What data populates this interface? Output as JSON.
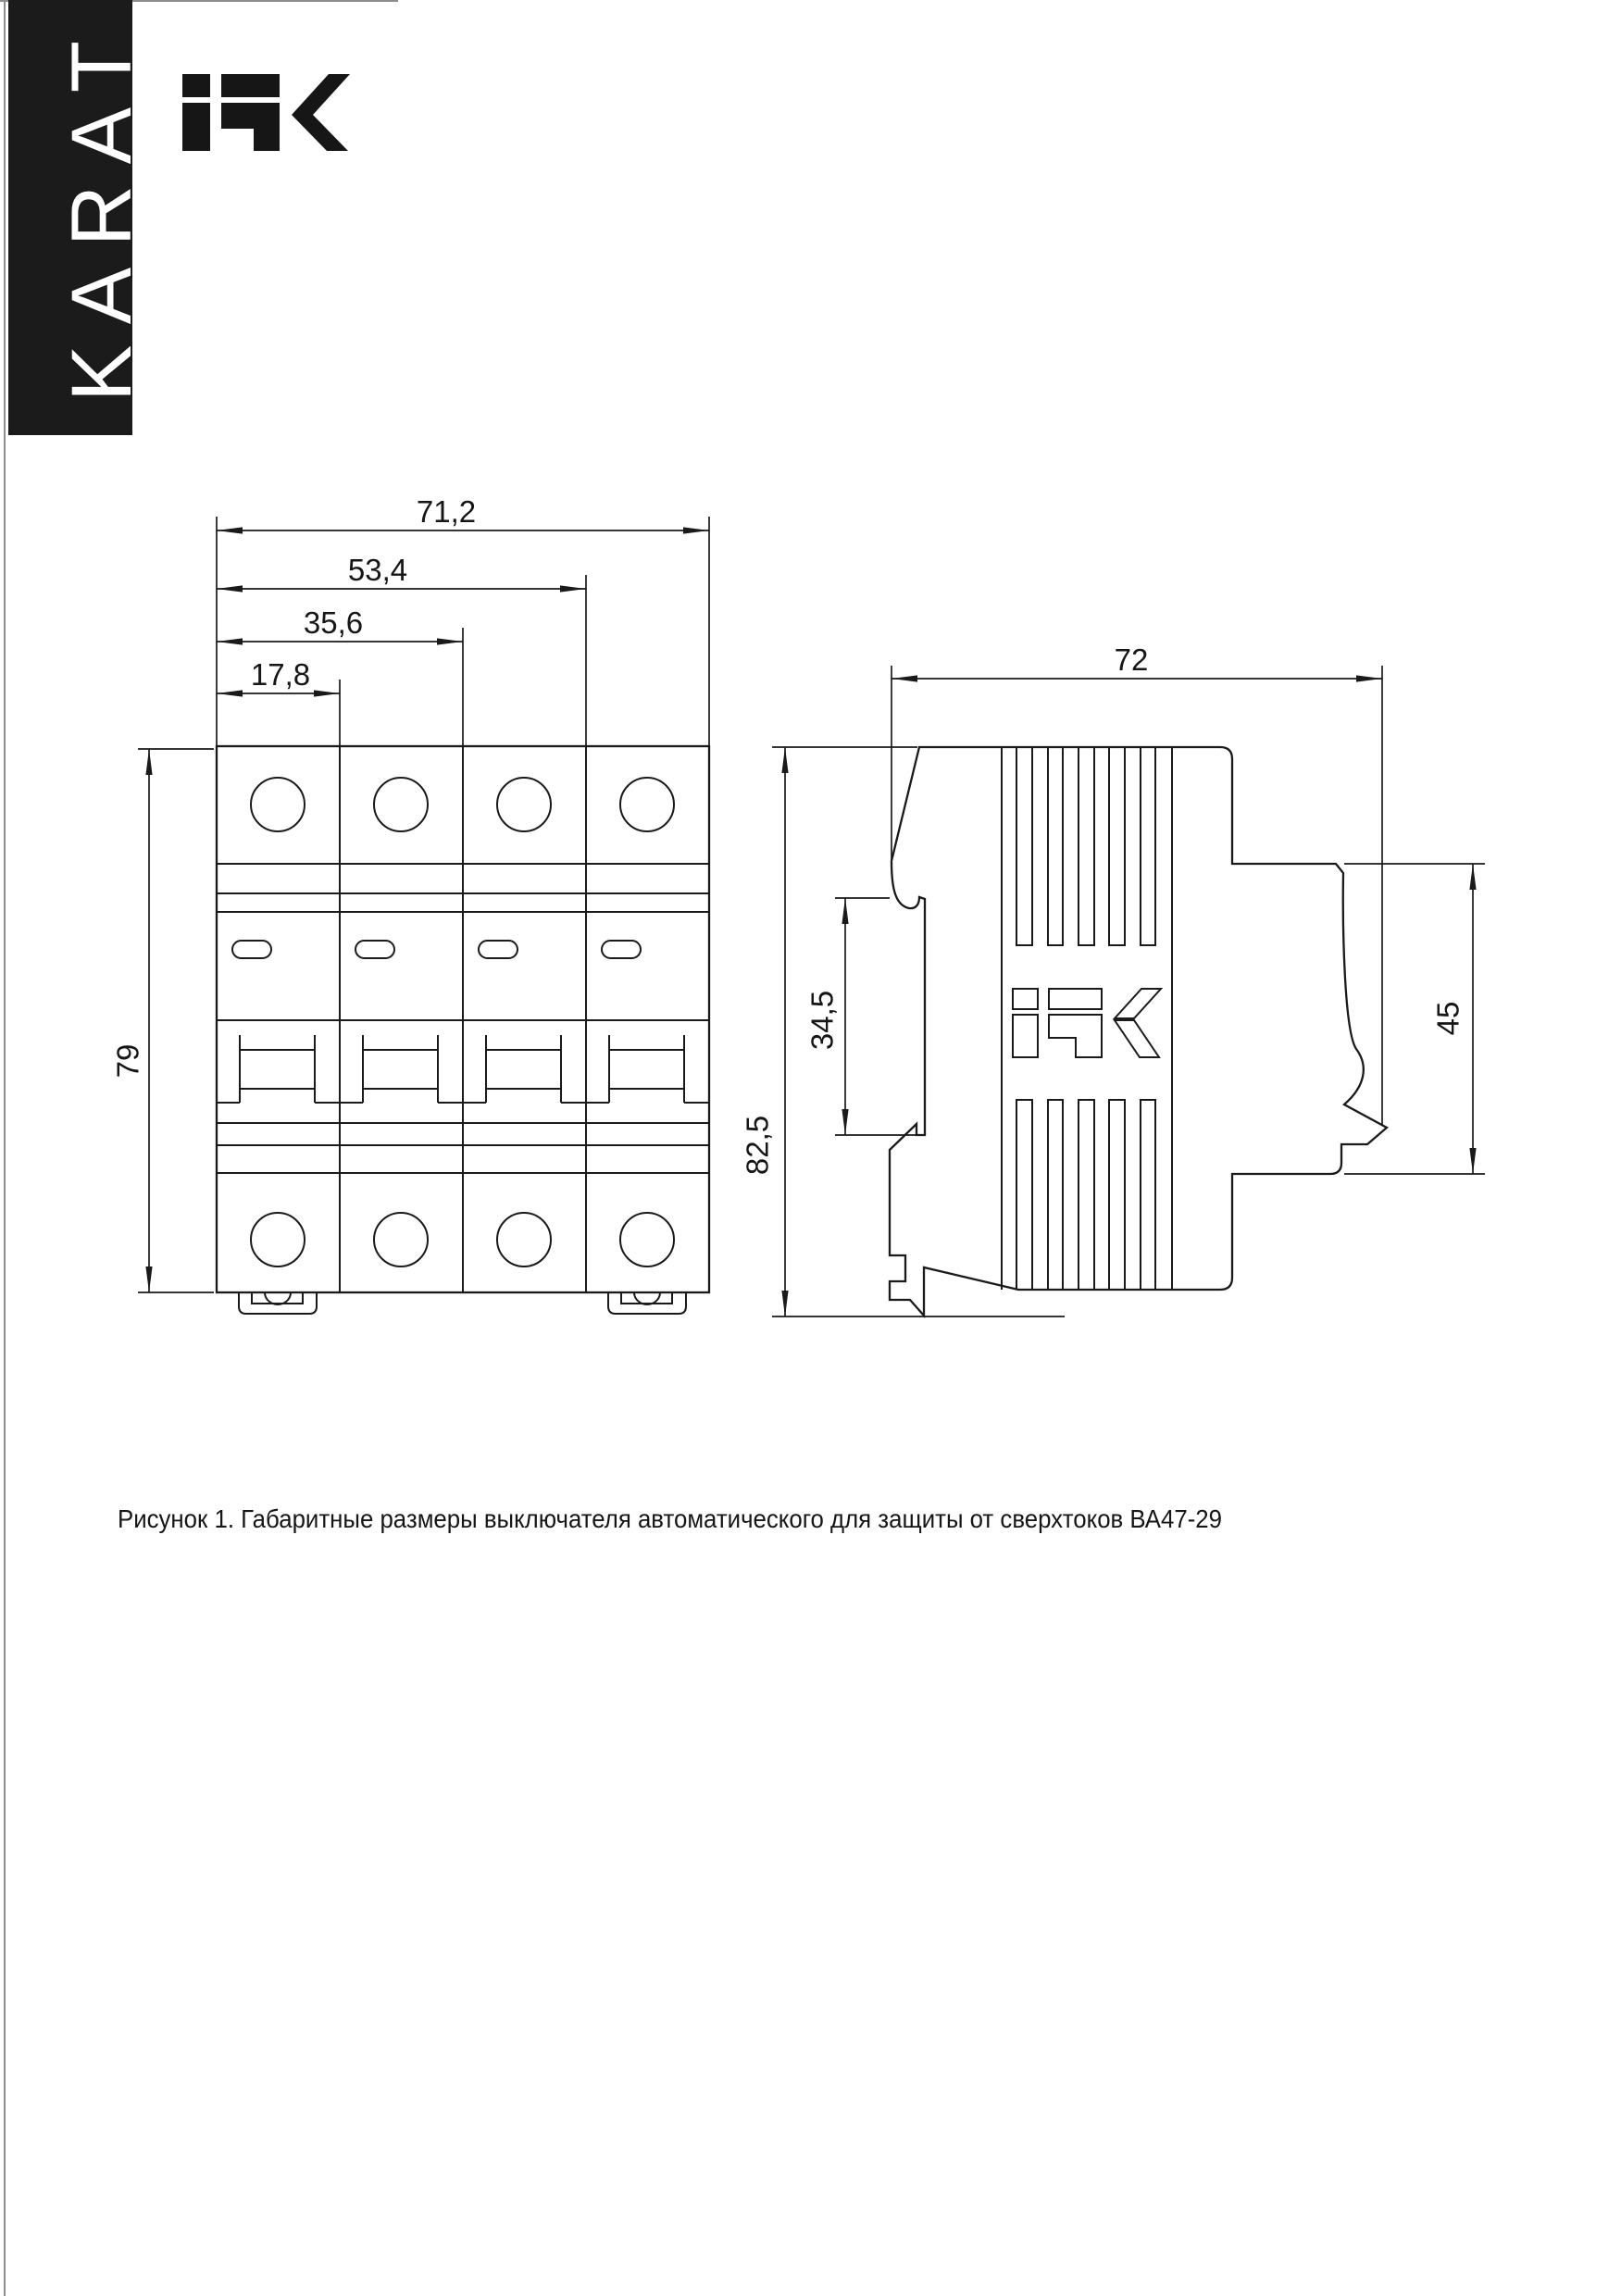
{
  "brand": {
    "vertical_banner": "KARAT",
    "logo_text": "iEK"
  },
  "figure": {
    "caption": "Рисунок 1. Габаритные размеры выключателя автоматического для защиты от сверхтоков ВА47-29",
    "product": "ВА47-29",
    "figure_number": "Рисунок 1"
  },
  "front_view": {
    "dim_total_width": "71,2",
    "dim_three_modules": "53,4",
    "dim_two_modules": "35,6",
    "dim_one_module": "17,8",
    "dim_height": "79"
  },
  "side_view": {
    "dim_depth": "72",
    "dim_total_height": "82,5",
    "dim_din_slot": "34,5",
    "dim_front_depth": "45"
  },
  "colors": {
    "line": "#1a1a1a",
    "banner_background": "#1b1b1b",
    "page_background": "#ffffff",
    "text": "#161616"
  }
}
